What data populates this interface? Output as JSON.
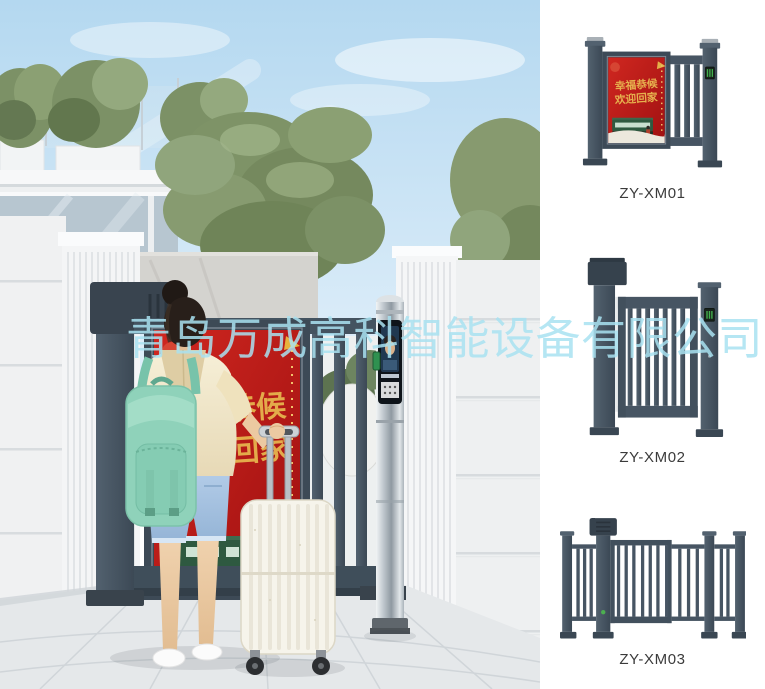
{
  "watermark": {
    "text": "青岛万成高科智能设备有限公司"
  },
  "hero": {
    "alt": "woman-with-mint-backpack-and-suitcase-entering-community-pedestrian-gate",
    "ad_display": {
      "line1": "幸福恭候",
      "line2": "欢迎回家"
    }
  },
  "products": [
    {
      "model": "ZY-XM01",
      "alt": "pedestrian-gate-with-advertising-display",
      "ad_line1": "幸福恭候",
      "ad_line2": "欢迎回家"
    },
    {
      "model": "ZY-XM02",
      "alt": "pedestrian-swing-gate-with-vertical-bars"
    },
    {
      "model": "ZY-XM03",
      "alt": "fence-style-pedestrian-swing-gate"
    }
  ],
  "colors": {
    "gate_slate": "#475663",
    "display_red": "#c01d18",
    "gold_text": "#e3ab4a",
    "watermark_cyan": "#a9e2f1",
    "backpack_mint": "#8fd2ba",
    "panel_background": "#ffffff"
  }
}
